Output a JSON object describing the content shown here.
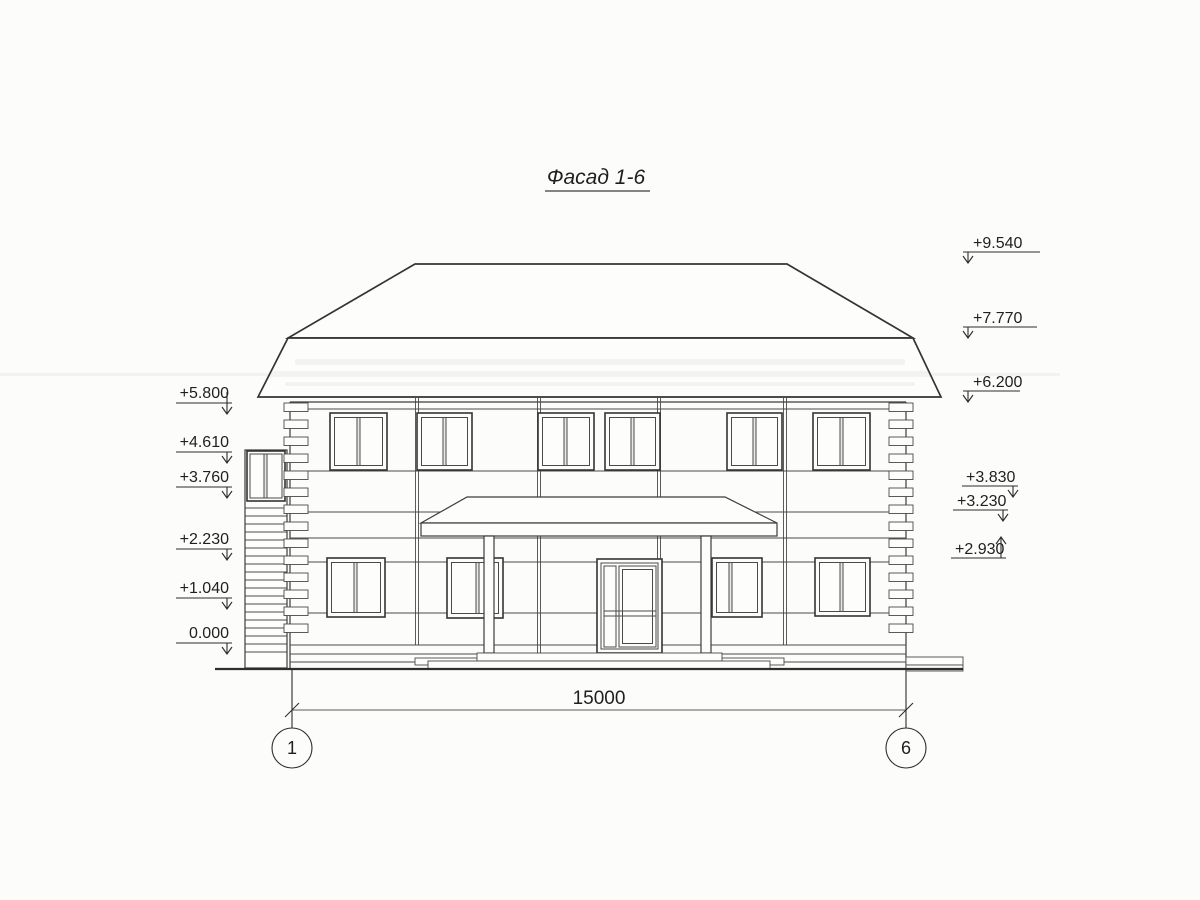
{
  "drawing": {
    "title": "Фасад 1-6",
    "sheet_background": "#fcfcfb",
    "line_color": "#3c3c3c",
    "text_color": "#1f1f1f"
  },
  "elevation_marks": {
    "left": [
      {
        "value": "+5.800"
      },
      {
        "value": "+4.610"
      },
      {
        "value": "+3.760"
      },
      {
        "value": "+2.230"
      },
      {
        "value": "+1.040"
      },
      {
        "value": "0.000"
      }
    ],
    "right": [
      {
        "value": "+9.540"
      },
      {
        "value": "+7.770"
      },
      {
        "value": "+6.200"
      },
      {
        "value": "+3.830"
      },
      {
        "value": "+3.230"
      },
      {
        "value": "+2.930"
      }
    ]
  },
  "dimension": {
    "value": "15000"
  },
  "axes": [
    {
      "label": "1"
    },
    {
      "label": "6"
    }
  ]
}
